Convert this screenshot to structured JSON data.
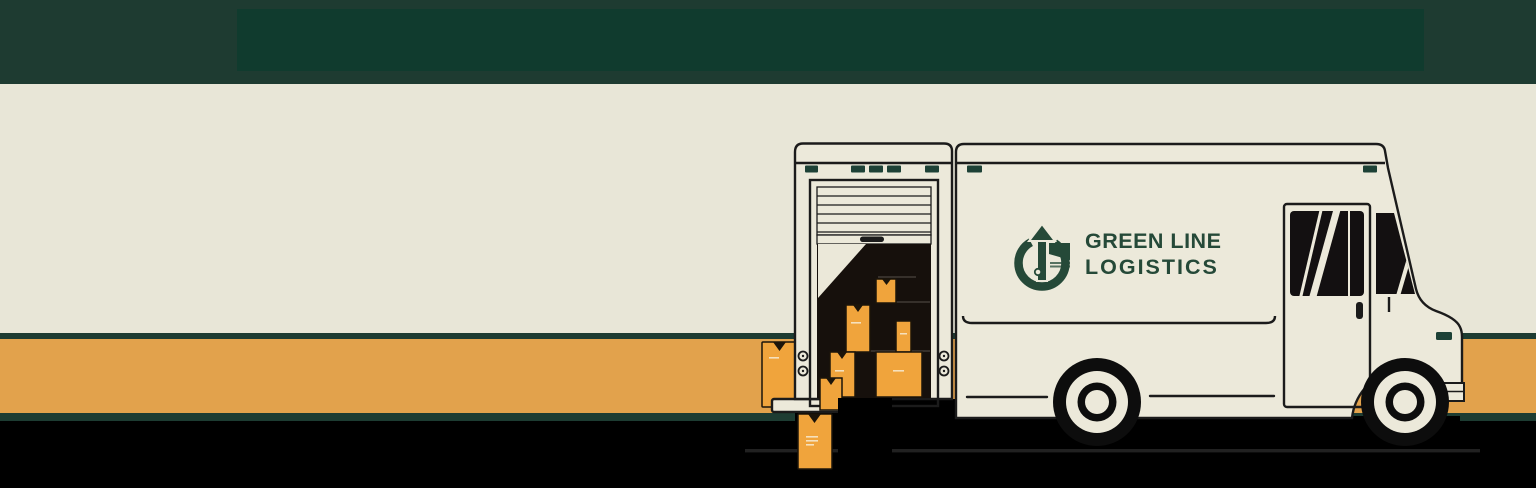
{
  "branding": {
    "line1": "GREEN LINE",
    "line2": "LOGISTICS"
  },
  "icons": {
    "logo_mark": "circle-with-up-arrow-icon"
  },
  "colors": {
    "header_green": "#1e3b31",
    "header_inner_green": "#103b2e",
    "cream_background": "#e8e6d7",
    "truck_cream": "#ece9da",
    "stripe_green": "#1d3c32",
    "stripe_orange": "#e2a24c",
    "package_orange": "#f0a43c",
    "logo_green": "#254938",
    "vent_green": "#1d4136",
    "outline_dark": "#1b1b1b",
    "interior_dark": "#16100c",
    "window_dark": "#131011",
    "footer_black": "#000000"
  }
}
